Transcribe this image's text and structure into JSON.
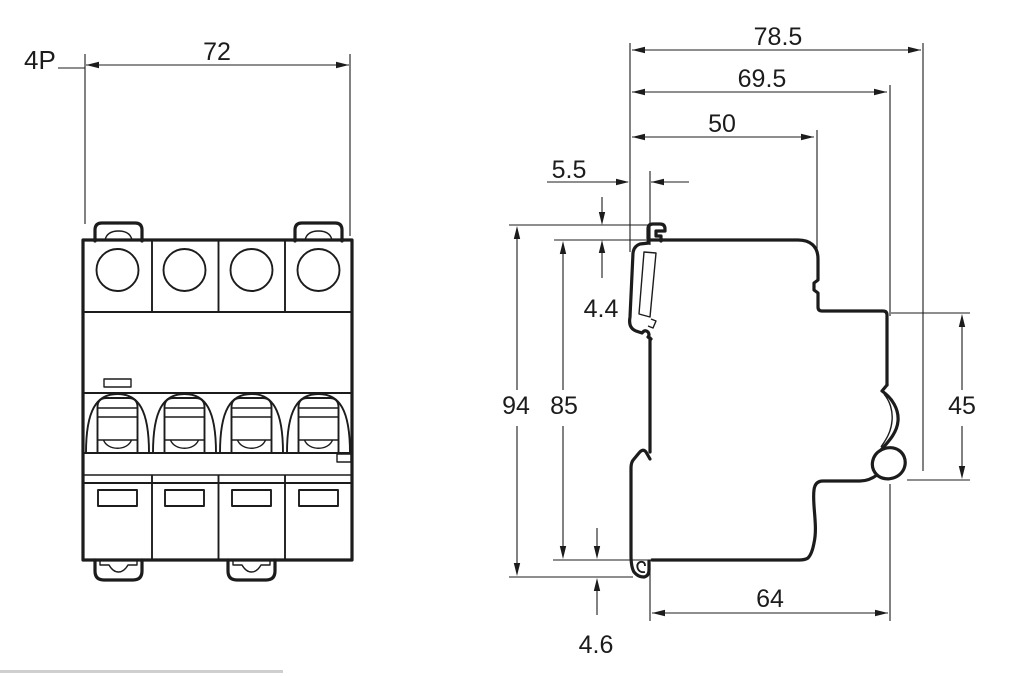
{
  "drawing": {
    "product_label": "4P",
    "front_view": {
      "width": "72"
    },
    "side_view": {
      "overall_depth": "78.5",
      "depth_to_front_face": "69.5",
      "depth_to_step": "50",
      "rail_clip_overhang": "5.5",
      "top_clip_offset": "4.4",
      "overall_height": "94",
      "body_height": "85",
      "front_face_height": "45",
      "base_depth": "64",
      "bottom_clip_offset": "4.6"
    }
  },
  "colors": {
    "line": "#1c1c1c",
    "background": "#ffffff",
    "footer_rule": "#cfcfcf"
  }
}
